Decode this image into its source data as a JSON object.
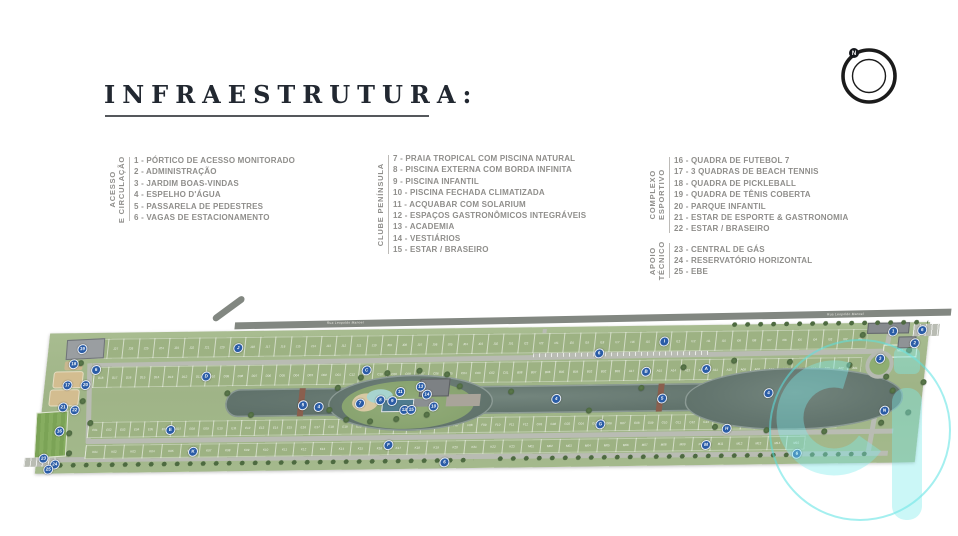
{
  "title": {
    "text": "INFRAESTRUTURA:"
  },
  "legend": {
    "groups": [
      {
        "label_lines": [
          "ACESSO",
          "E CIRCULAÇÃO"
        ],
        "items": [
          "1 - PÓRTICO DE ACESSO MONITORADO",
          "2 - ADMINISTRAÇÃO",
          "3 - JARDIM BOAS-VINDAS",
          "4 - ESPELHO D'ÁGUA",
          "5 - PASSARELA DE PEDESTRES",
          "6 - VAGAS DE ESTACIONAMENTO"
        ]
      },
      {
        "label_lines": [
          "CLUBE PENÍNSULA"
        ],
        "items": [
          "7 - PRAIA TROPICAL COM PISCINA NATURAL",
          "8 - PISCINA EXTERNA COM BORDA INFINITA",
          "9 - PISCINA INFANTIL",
          "10 - PISCINA FECHADA CLIMATIZADA",
          "11 - ACQUABAR COM SOLARIUM",
          "12 - ESPAÇOS GASTRONÔMICOS INTEGRÁVEIS",
          "13 - ACADEMIA",
          "14 - VESTIÁRIOS",
          "15 - ESTAR / BRASEIRO"
        ]
      },
      {
        "label_lines": [
          "COMPLEXO",
          "ESPORTIVO"
        ],
        "items": [
          "16 - QUADRA DE FUTEBOL 7",
          "17 - 3 QUADRAS DE BEACH TENNIS",
          "18 - QUADRA DE PICKLEBALL",
          "19 - QUADRA DE TÊNIS COBERTA",
          "20 - PARQUE INFANTIL",
          "21 - ESTAR DE ESPORTE & GASTRONOMIA",
          "22 - ESTAR / BRASEIRO"
        ]
      },
      {
        "label_lines": [
          "APOIO",
          "TÉCNICO"
        ],
        "items": [
          "23 - CENTRAL DE GÁS",
          "24 - RESERVATÓRIO HORIZONTAL",
          "25 - EBE"
        ]
      }
    ]
  },
  "compass": {
    "north_label": "N"
  },
  "plan": {
    "road_label": "Rua Leopoldo Manoel",
    "colors": {
      "lot_green": "#9db283",
      "bank_green": "#a4b98c",
      "water": "#64766f",
      "road_light": "#b9bcb3",
      "road_dark": "#828781",
      "marker_blue": "#2a5ca6",
      "sand": "#d3bd90",
      "watermark_cyan": "#7de3e3"
    },
    "lot_rows": [
      {
        "x": 56,
        "y": 34,
        "w": 775,
        "h": 20,
        "segments": [
          {
            "s": "J",
            "from": 28,
            "to": 1
          },
          {
            "s": "I",
            "from": 23,
            "to": 1
          }
        ]
      },
      {
        "x": 60,
        "y": 62,
        "w": 768,
        "h": 21,
        "segments": [
          {
            "s": "D",
            "from": 18,
            "to": 1
          },
          {
            "s": "C",
            "from": 12,
            "to": 1
          },
          {
            "s": "B",
            "from": 8,
            "to": 1
          },
          {
            "s": "A",
            "from": 17,
            "to": 1
          }
        ]
      },
      {
        "x": 60,
        "y": 117,
        "w": 750,
        "h": 16,
        "segments": [
          {
            "s": "E",
            "from": 1,
            "to": 20
          },
          {
            "s": "F",
            "from": 1,
            "to": 12
          },
          {
            "s": "G",
            "from": 1,
            "to": 14
          },
          {
            "s": "H",
            "from": 11,
            "to": 18
          }
        ]
      },
      {
        "x": 60,
        "y": 140,
        "w": 720,
        "h": 14,
        "segments": [
          {
            "s": "K",
            "from": 1,
            "to": 23
          },
          {
            "s": "M",
            "from": 1,
            "to": 15
          }
        ]
      }
    ],
    "n_column": {
      "x": 848,
      "y": 50,
      "labels": [
        "N10",
        "N09",
        "N08",
        "N07",
        "N06",
        "N05",
        "N04",
        "N03",
        "N02",
        "N01"
      ]
    },
    "markers": [
      {
        "label": "1",
        "x": 855,
        "y": 36
      },
      {
        "label": "2",
        "x": 878,
        "y": 48
      },
      {
        "label": "3",
        "x": 845,
        "y": 63
      },
      {
        "label": "6",
        "x": 884,
        "y": 35
      },
      {
        "label": "6",
        "x": 61,
        "y": 64
      },
      {
        "label": "6",
        "x": 563,
        "y": 54
      },
      {
        "label": "6",
        "x": 420,
        "y": 161
      },
      {
        "label": "6",
        "x": 772,
        "y": 157
      },
      {
        "label": "4",
        "x": 288,
        "y": 104
      },
      {
        "label": "4",
        "x": 525,
        "y": 99
      },
      {
        "label": "4",
        "x": 737,
        "y": 96
      },
      {
        "label": "5",
        "x": 272,
        "y": 102
      },
      {
        "label": "5",
        "x": 631,
        "y": 100
      },
      {
        "label": "7",
        "x": 329,
        "y": 101
      },
      {
        "label": "8",
        "x": 349,
        "y": 98
      },
      {
        "label": "9",
        "x": 361,
        "y": 99
      },
      {
        "label": "10",
        "x": 403,
        "y": 105
      },
      {
        "label": "11",
        "x": 368,
        "y": 90
      },
      {
        "label": "12",
        "x": 374,
        "y": 108
      },
      {
        "label": "13",
        "x": 388,
        "y": 85
      },
      {
        "label": "14",
        "x": 395,
        "y": 93
      },
      {
        "label": "15",
        "x": 381,
        "y": 108
      },
      {
        "label": "16",
        "x": 31,
        "y": 125
      },
      {
        "label": "17",
        "x": 34,
        "y": 79
      },
      {
        "label": "18",
        "x": 38,
        "y": 58
      },
      {
        "label": "19",
        "x": 45,
        "y": 43
      },
      {
        "label": "20",
        "x": 52,
        "y": 79
      },
      {
        "label": "21",
        "x": 32,
        "y": 101
      },
      {
        "label": "22",
        "x": 44,
        "y": 104
      },
      {
        "label": "23",
        "x": 18,
        "y": 152
      },
      {
        "label": "24",
        "x": 30,
        "y": 158
      },
      {
        "label": "25",
        "x": 24,
        "y": 163
      },
      {
        "label": "J",
        "x": 201,
        "y": 44
      },
      {
        "label": "I",
        "x": 627,
        "y": 43
      },
      {
        "label": "D",
        "x": 172,
        "y": 72
      },
      {
        "label": "C",
        "x": 332,
        "y": 68
      },
      {
        "label": "A",
        "x": 672,
        "y": 71
      },
      {
        "label": "B",
        "x": 612,
        "y": 73
      },
      {
        "label": "E",
        "x": 142,
        "y": 125
      },
      {
        "label": "F",
        "x": 362,
        "y": 143
      },
      {
        "label": "G",
        "x": 572,
        "y": 125
      },
      {
        "label": "H",
        "x": 699,
        "y": 131
      },
      {
        "label": "K",
        "x": 167,
        "y": 147
      },
      {
        "label": "M",
        "x": 680,
        "y": 147
      },
      {
        "label": "N",
        "x": 855,
        "y": 115
      }
    ],
    "trees": [
      {
        "x": 306,
        "y": 86
      },
      {
        "x": 300,
        "y": 108
      },
      {
        "x": 318,
        "y": 118
      },
      {
        "x": 342,
        "y": 120
      },
      {
        "x": 368,
        "y": 118
      },
      {
        "x": 398,
        "y": 114
      },
      {
        "x": 428,
        "y": 86
      },
      {
        "x": 414,
        "y": 74
      },
      {
        "x": 386,
        "y": 70
      },
      {
        "x": 354,
        "y": 72
      },
      {
        "x": 328,
        "y": 76
      },
      {
        "x": 650,
        "y": 70
      },
      {
        "x": 700,
        "y": 64
      },
      {
        "x": 756,
        "y": 66
      },
      {
        "x": 816,
        "y": 70
      },
      {
        "x": 862,
        "y": 96
      },
      {
        "x": 854,
        "y": 128
      },
      {
        "x": 798,
        "y": 136
      },
      {
        "x": 740,
        "y": 134
      },
      {
        "x": 688,
        "y": 130
      },
      {
        "x": 46,
        "y": 58
      },
      {
        "x": 52,
        "y": 96
      },
      {
        "x": 42,
        "y": 128
      },
      {
        "x": 62,
        "y": 118
      },
      {
        "x": 826,
        "y": 40
      },
      {
        "x": 854,
        "y": 82
      },
      {
        "x": 874,
        "y": 56
      },
      {
        "x": 892,
        "y": 88
      },
      {
        "x": 880,
        "y": 118
      },
      {
        "x": 196,
        "y": 90
      },
      {
        "x": 222,
        "y": 112
      },
      {
        "x": 480,
        "y": 92
      },
      {
        "x": 560,
        "y": 112
      },
      {
        "x": 610,
        "y": 90
      },
      {
        "x": 44,
        "y": 148
      }
    ]
  }
}
